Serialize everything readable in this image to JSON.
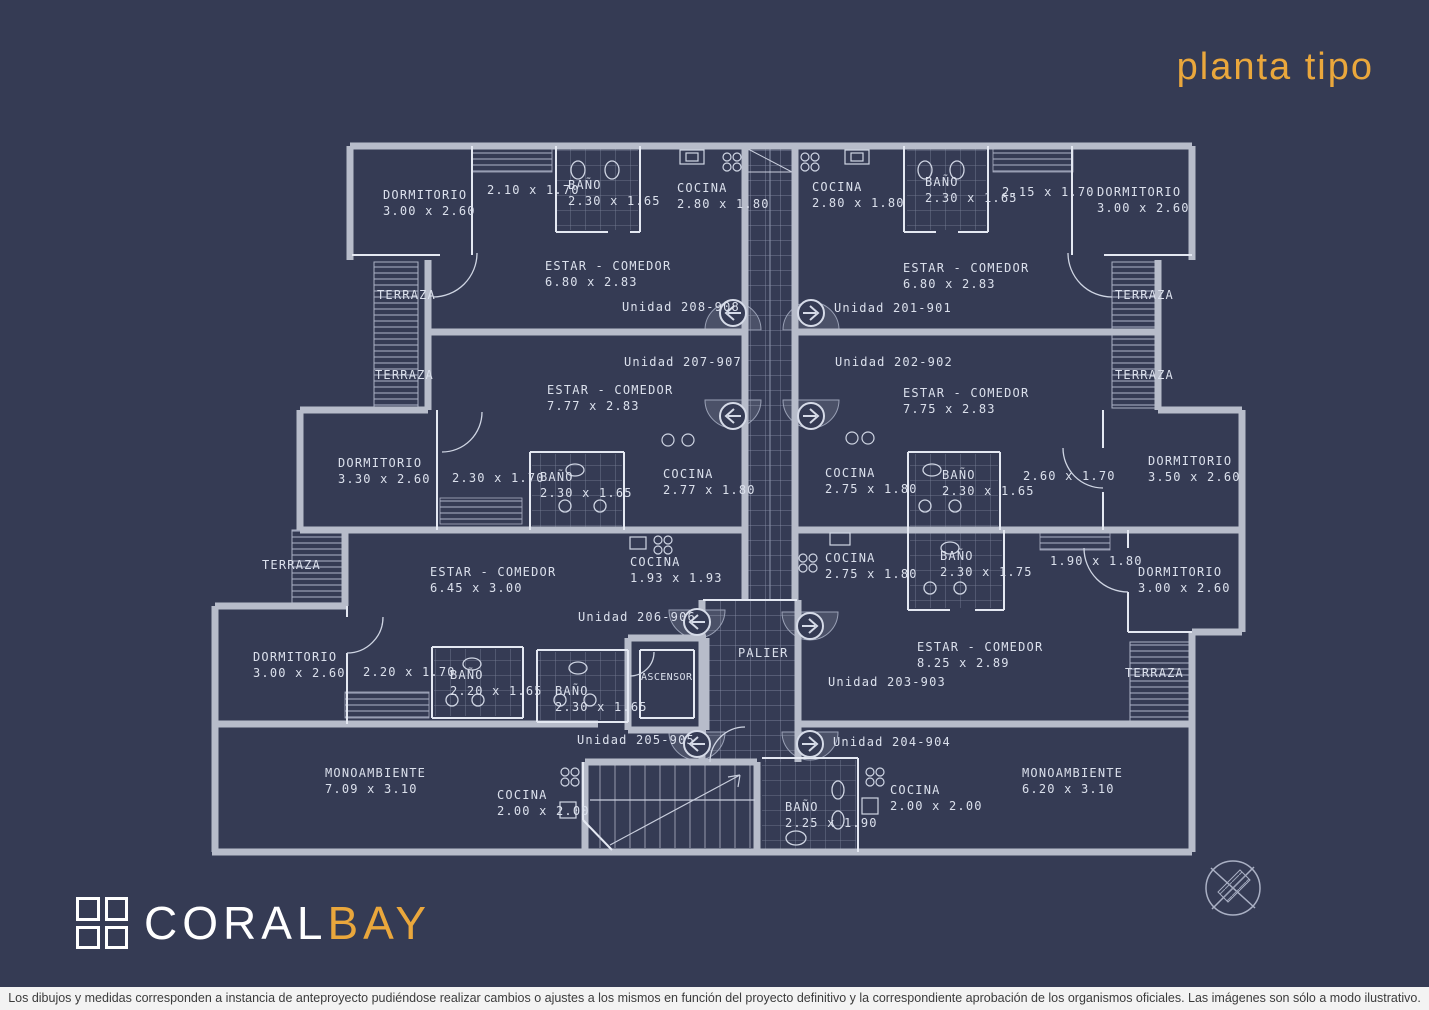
{
  "title": "planta tipo",
  "logo": {
    "coral": "CORAL",
    "bay": "BAY",
    "icon": "window-grid-icon"
  },
  "disclaimer": "Los dibujos y medidas corresponden a instancia de anteproyecto pudiéndose realizar cambios o ajustes a los mismos en función del proyecto definitivo y la correspondiente aprobación de los organismos oficiales. Las imágenes son sólo a modo ilustrativo.",
  "colors": {
    "background": "#353B54",
    "wall": "#B7BCCA",
    "partition": "#E4E8F2",
    "label": "#DBE0EC",
    "accent_orange": "#EAA73C",
    "disclaimer_bg": "#F3F3F3"
  },
  "plan": {
    "labels": [
      {
        "l1": "DORMITORIO",
        "l2": "3.00 x 2.60"
      },
      {
        "l1": "2.10 x 1.70",
        "l2": ""
      },
      {
        "l1": "BAÑO",
        "l2": "2.30 x 1.65"
      },
      {
        "l1": "COCINA",
        "l2": "2.80 x 1.80"
      },
      {
        "l1": "COCINA",
        "l2": "2.80 x 1.80"
      },
      {
        "l1": "BAÑO",
        "l2": "2.30 x 1.65"
      },
      {
        "l1": "2.15 x 1.70",
        "l2": ""
      },
      {
        "l1": "DORMITORIO",
        "l2": "3.00 x 2.60"
      },
      {
        "l1": "ESTAR - COMEDOR",
        "l2": "6.80 x 2.83"
      },
      {
        "l1": "ESTAR - COMEDOR",
        "l2": "6.80 x 2.83"
      },
      {
        "l1": "TERRAZA",
        "l2": ""
      },
      {
        "l1": "TERRAZA",
        "l2": ""
      },
      {
        "l1": "Unidad 208-908",
        "l2": ""
      },
      {
        "l1": "Unidad 201-901",
        "l2": ""
      },
      {
        "l1": "Unidad 207-907",
        "l2": ""
      },
      {
        "l1": "Unidad 202-902",
        "l2": ""
      },
      {
        "l1": "TERRAZA",
        "l2": ""
      },
      {
        "l1": "TERRAZA",
        "l2": ""
      },
      {
        "l1": "ESTAR - COMEDOR",
        "l2": "7.77 x 2.83"
      },
      {
        "l1": "ESTAR - COMEDOR",
        "l2": "7.75 x 2.83"
      },
      {
        "l1": "DORMITORIO",
        "l2": "3.30 x 2.60"
      },
      {
        "l1": "2.30 x 1.70",
        "l2": ""
      },
      {
        "l1": "BAÑO",
        "l2": "2.30 x 1.65"
      },
      {
        "l1": "COCINA",
        "l2": "2.77 x 1.80"
      },
      {
        "l1": "COCINA",
        "l2": "2.75 x 1.80"
      },
      {
        "l1": "BAÑO",
        "l2": "2.30 x 1.65"
      },
      {
        "l1": "2.60 x 1.70",
        "l2": ""
      },
      {
        "l1": "DORMITORIO",
        "l2": "3.50 x 2.60"
      },
      {
        "l1": "TERRAZA",
        "l2": ""
      },
      {
        "l1": "ESTAR - COMEDOR",
        "l2": "6.45 x 3.00"
      },
      {
        "l1": "COCINA",
        "l2": "1.93 x 1.93"
      },
      {
        "l1": "COCINA",
        "l2": "2.75 x 1.80"
      },
      {
        "l1": "BAÑO",
        "l2": "2.30 x 1.75"
      },
      {
        "l1": "1.90 x 1.80",
        "l2": ""
      },
      {
        "l1": "DORMITORIO",
        "l2": "3.00 x 2.60"
      },
      {
        "l1": "Unidad 206-906",
        "l2": ""
      },
      {
        "l1": "DORMITORIO",
        "l2": "3.00 x 2.60"
      },
      {
        "l1": "2.20 x 1.70",
        "l2": ""
      },
      {
        "l1": "BAÑO",
        "l2": "2.20 x 1.65"
      },
      {
        "l1": "BAÑO",
        "l2": "2.30 x 1.65"
      },
      {
        "l1": "ASCENSOR",
        "l2": ""
      },
      {
        "l1": "PALIER",
        "l2": ""
      },
      {
        "l1": "ESTAR - COMEDOR",
        "l2": "8.25 x 2.89"
      },
      {
        "l1": "Unidad 203-903",
        "l2": ""
      },
      {
        "l1": "TERRAZA",
        "l2": ""
      },
      {
        "l1": "Unidad 205-905",
        "l2": ""
      },
      {
        "l1": "Unidad 204-904",
        "l2": ""
      },
      {
        "l1": "MONOAMBIENTE",
        "l2": "7.09 x 3.10"
      },
      {
        "l1": "COCINA",
        "l2": "2.00 x 2.00"
      },
      {
        "l1": "BAÑO",
        "l2": "2.25 x 1.90"
      },
      {
        "l1": "COCINA",
        "l2": "2.00 x 2.00"
      },
      {
        "l1": "MONOAMBIENTE",
        "l2": "6.20 x 3.10"
      }
    ]
  }
}
